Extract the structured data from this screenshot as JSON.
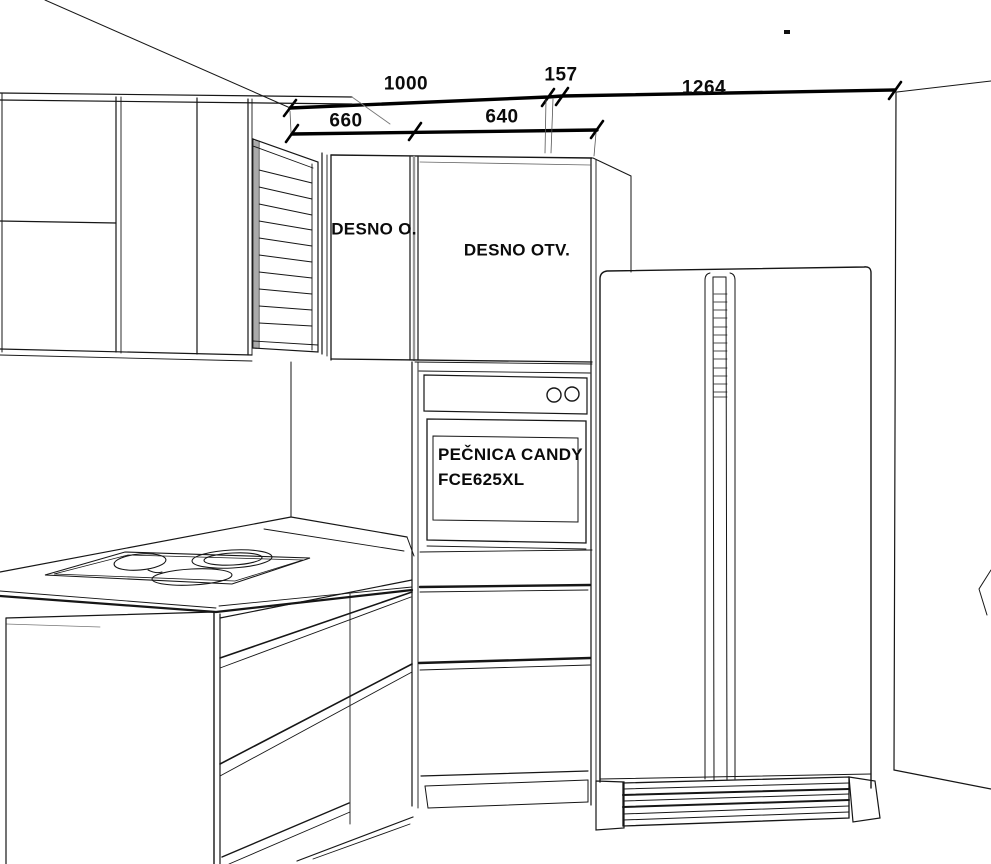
{
  "drawing_title": "kitchen-elevation-sketch",
  "dimensions": {
    "top_row": [
      {
        "name": "tall-unit-width",
        "value": "1000"
      },
      {
        "name": "gap-width",
        "value": "157"
      },
      {
        "name": "fridge-width",
        "value": "1264"
      }
    ],
    "second_row": [
      {
        "name": "left-column-width",
        "value": "660"
      },
      {
        "name": "oven-column-width",
        "value": "640"
      }
    ]
  },
  "labels": {
    "upper_door_left": "DESNO O.",
    "upper_door_right": "DESNO OTV.",
    "oven_brand_line1": "PEČNICA CANDY",
    "oven_brand_line2": "FCE625XL"
  },
  "colors": {
    "line": "#161616",
    "dimension_line": "#000000",
    "background": "#ffffff"
  }
}
